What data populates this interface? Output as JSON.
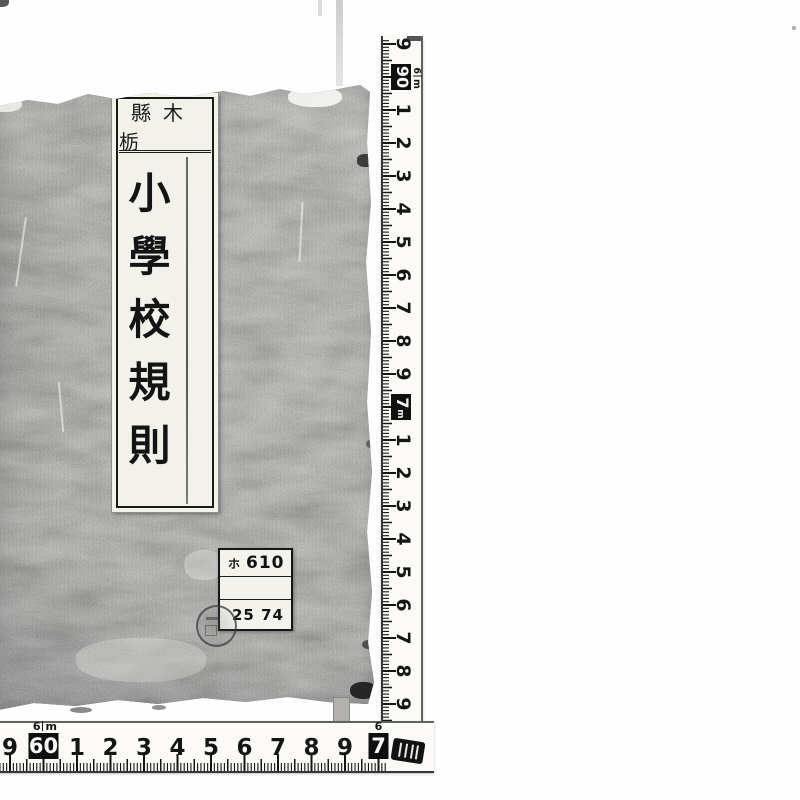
{
  "book": {
    "cover_color": "#94938e",
    "title_label": {
      "header_text": "縣木栃",
      "title_text": "小學校規則"
    },
    "catalog_label": {
      "row1_kana": "ホ",
      "row1_number": "610",
      "row2_text": "",
      "row3_text": "25 74"
    }
  },
  "rulers": {
    "ink_color": "#151515",
    "tape_color": "#fbfaf6",
    "vertical": {
      "lead_digit": "9",
      "decimeter_box": "90",
      "meter_label": "6m",
      "cm_digits_a": [
        "1",
        "2",
        "3",
        "4",
        "5",
        "6",
        "7",
        "8",
        "9"
      ],
      "meter_box": "7m",
      "cm_digits_b": [
        "1",
        "2",
        "3",
        "4",
        "5",
        "6",
        "7",
        "8",
        "9"
      ]
    },
    "horizontal": {
      "lead_digit": "9",
      "decimeter_box": "60",
      "meter_label": "6m",
      "cm_digits": [
        "1",
        "2",
        "3",
        "4",
        "5",
        "6",
        "7",
        "8",
        "9"
      ],
      "end_meter_label": "6",
      "end_box_digit": "7"
    }
  }
}
